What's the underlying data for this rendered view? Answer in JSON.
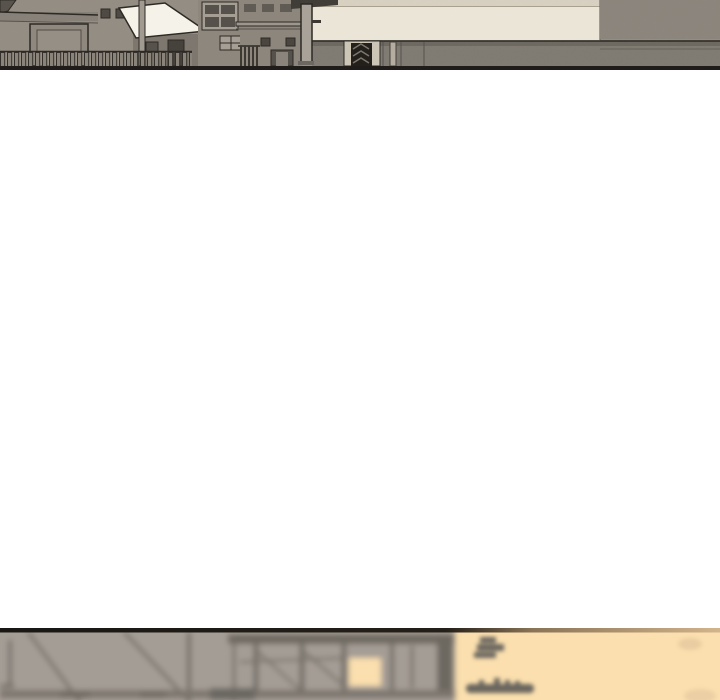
{
  "page": {
    "kind": "vertical-scroll comic reader page",
    "width_px": 720,
    "height_px": 700,
    "visible_text": "none"
  },
  "panels": {
    "top": {
      "alt": "Comic panel strip: gray-brown alley of low buildings with dark outlines, a slatted fence, a utility pole, a bright white slanted roof, an awning column, and a large pale cream wall with a dark doorway",
      "height_px": 70,
      "cut_off": "top edge of page"
    },
    "gap": {
      "alt": "blank white gutter between comic panels",
      "height_px": 558
    },
    "bottom": {
      "alt": "Comic panel strip (blurred foreground): out-of-focus scaffold beams and posts of an unfinished structure on the left, warm peach sunset sky on the right with small blurred silhouettes",
      "height_px": 72,
      "cut_off": "bottom edge of page"
    }
  },
  "palette": {
    "page_background": "#ffffff",
    "ink": "#241f1b",
    "building_gray": "#948d83",
    "cream_wall": "#ece6d9",
    "white_roof": "#f6f3ea",
    "band_gray": "#7f7a72",
    "blur_gray": "#a49d95",
    "beam_gray": "#6e6961",
    "sunset_peach": "#fbdfae",
    "panel_border": "#1f1c19"
  }
}
